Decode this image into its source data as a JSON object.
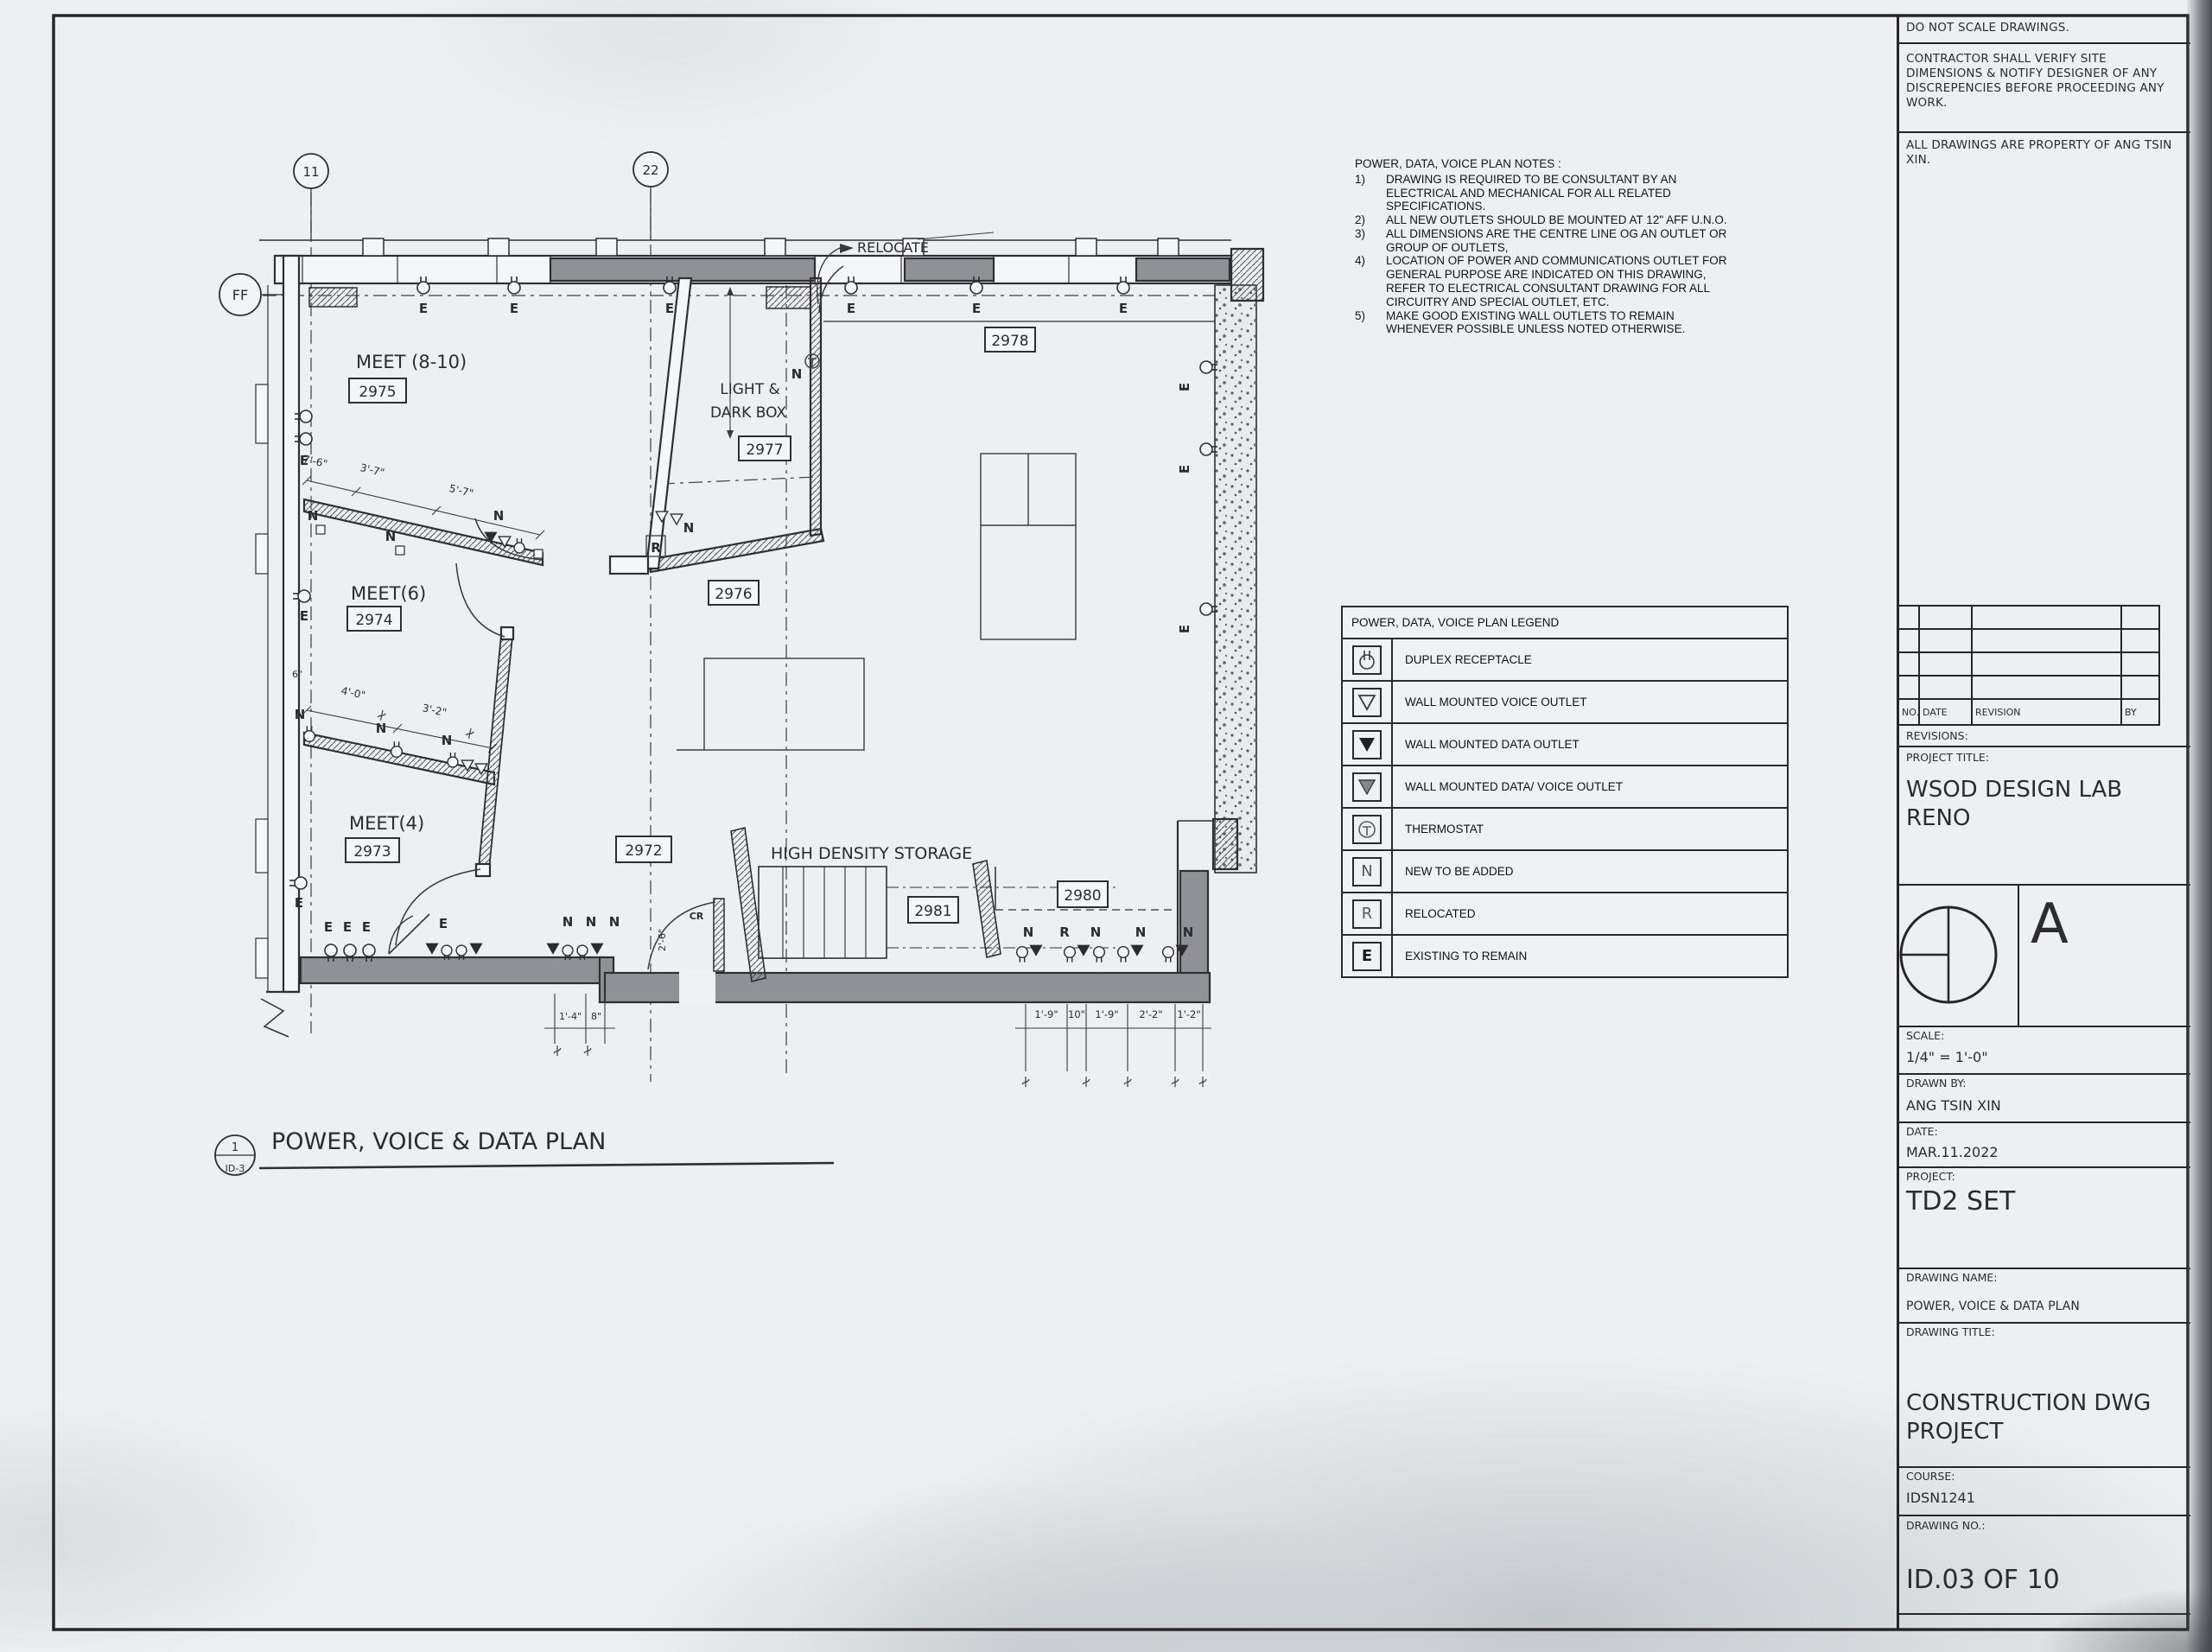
{
  "plan": {
    "grid": {
      "g1": "11",
      "g2": "22",
      "gf": "FF"
    },
    "view_title": {
      "num": "1",
      "sheet": "ID-3",
      "label": "POWER, VOICE & DATA PLAN"
    },
    "relocate": "RELOCATE",
    "rooms": {
      "meet810": {
        "name": "MEET (8-10)",
        "num": "2975"
      },
      "meet6": {
        "name": "MEET(6)",
        "num": "2974"
      },
      "meet4": {
        "name": "MEET(4)",
        "num": "2973"
      },
      "r2976": {
        "num": "2976"
      },
      "lightbox": {
        "name1": "LIGHT &",
        "name2": "DARK BOX",
        "num": "2977"
      },
      "r2978": {
        "num": "2978"
      },
      "r2972": {
        "num": "2972"
      },
      "storage": {
        "name": "HIGH DENSITY STORAGE",
        "num": "2981"
      },
      "r2980": {
        "num": "2980"
      }
    },
    "dims": {
      "d76": "7'-6\"",
      "d37": "3'-7\"",
      "d57": "5'-7\"",
      "d40": "4'-0\"",
      "d32": "3'-2\"",
      "d6": "6\"",
      "d26": "2'-6\"",
      "d14": "1'-4\"",
      "d8": "8\"",
      "d19": "1'-9\"",
      "d10": "10\"",
      "d19b": "1'-9\"",
      "d22": "2'-2\"",
      "d12": "1'-2\""
    },
    "markers": {
      "e": "E",
      "n": "N",
      "r": "R",
      "cr": "CR"
    }
  },
  "notes": {
    "title": "POWER, DATA, VOICE PLAN NOTES :",
    "items": [
      {
        "num": "1)",
        "text": "DRAWING IS REQUIRED TO BE CONSULTANT BY AN ELECTRICAL AND MECHANICAL FOR ALL RELATED SPECIFICATIONS."
      },
      {
        "num": "2)",
        "text": "ALL NEW OUTLETS SHOULD BE MOUNTED AT 12\" AFF U.N.O."
      },
      {
        "num": "3)",
        "text": "ALL DIMENSIONS ARE THE CENTRE LINE OG AN OUTLET OR GROUP OF OUTLETS,"
      },
      {
        "num": "4)",
        "text": "LOCATION OF POWER AND COMMUNICATIONS OUTLET FOR GENERAL PURPOSE ARE INDICATED ON THIS DRAWING, REFER TO ELECTRICAL CONSULTANT DRAWING FOR ALL CIRCUITRY AND SPECIAL OUTLET, ETC."
      },
      {
        "num": "5)",
        "text": "MAKE GOOD EXISTING WALL OUTLETS TO REMAIN WHENEVER POSSIBLE UNLESS NOTED OTHERWISE."
      }
    ]
  },
  "legend": {
    "title": "POWER, DATA, VOICE PLAN LEGEND",
    "rows": [
      {
        "label": "DUPLEX RECEPTACLE"
      },
      {
        "label": "WALL MOUNTED VOICE OUTLET"
      },
      {
        "label": "WALL MOUNTED DATA OUTLET"
      },
      {
        "label": "WALL MOUNTED DATA/ VOICE OUTLET"
      },
      {
        "label": "THERMOSTAT"
      },
      {
        "label": "NEW TO BE ADDED",
        "glyph": "N"
      },
      {
        "label": "RELOCATED",
        "glyph": "R"
      },
      {
        "label": "EXISTING TO REMAIN",
        "glyph": "E"
      }
    ]
  },
  "titleblock": {
    "note1": "DO NOT SCALE DRAWINGS.",
    "note2": "CONTRACTOR SHALL VERIFY SITE DIMENSIONS & NOTIFY DESIGNER OF ANY DISCREPENCIES BEFORE PROCEEDING ANY WORK.",
    "note3": "ALL DRAWINGS ARE PROPERTY OF ANG TSIN XIN.",
    "rev": {
      "no": "NO.",
      "date": "DATE",
      "revision": "REVISION",
      "by": "BY"
    },
    "revisions_label": "REVISIONS:",
    "project_title_label": "PROJECT TITLE:",
    "project_title": "WSOD DESIGN LAB\nRENO",
    "north_letter": "A",
    "scale_label": "SCALE:",
    "scale_value": "1/4\" = 1'-0\"",
    "drawn_by_label": "DRAWN BY:",
    "drawn_by": "ANG TSIN XIN",
    "date_label": "DATE:",
    "date": "MAR.11.2022",
    "project_label": "PROJECT:",
    "project": "TD2 SET",
    "drawing_name_label": "DRAWING NAME:",
    "drawing_name": "POWER, VOICE & DATA PLAN",
    "drawing_title_label": "DRAWING TITLE:",
    "drawing_title": "CONSTRUCTION DWG\nPROJECT",
    "course_label": "COURSE:",
    "course": "IDSN1241",
    "drawing_no_label": "DRAWING NO.:",
    "drawing_no": "ID.03 OF 10"
  }
}
